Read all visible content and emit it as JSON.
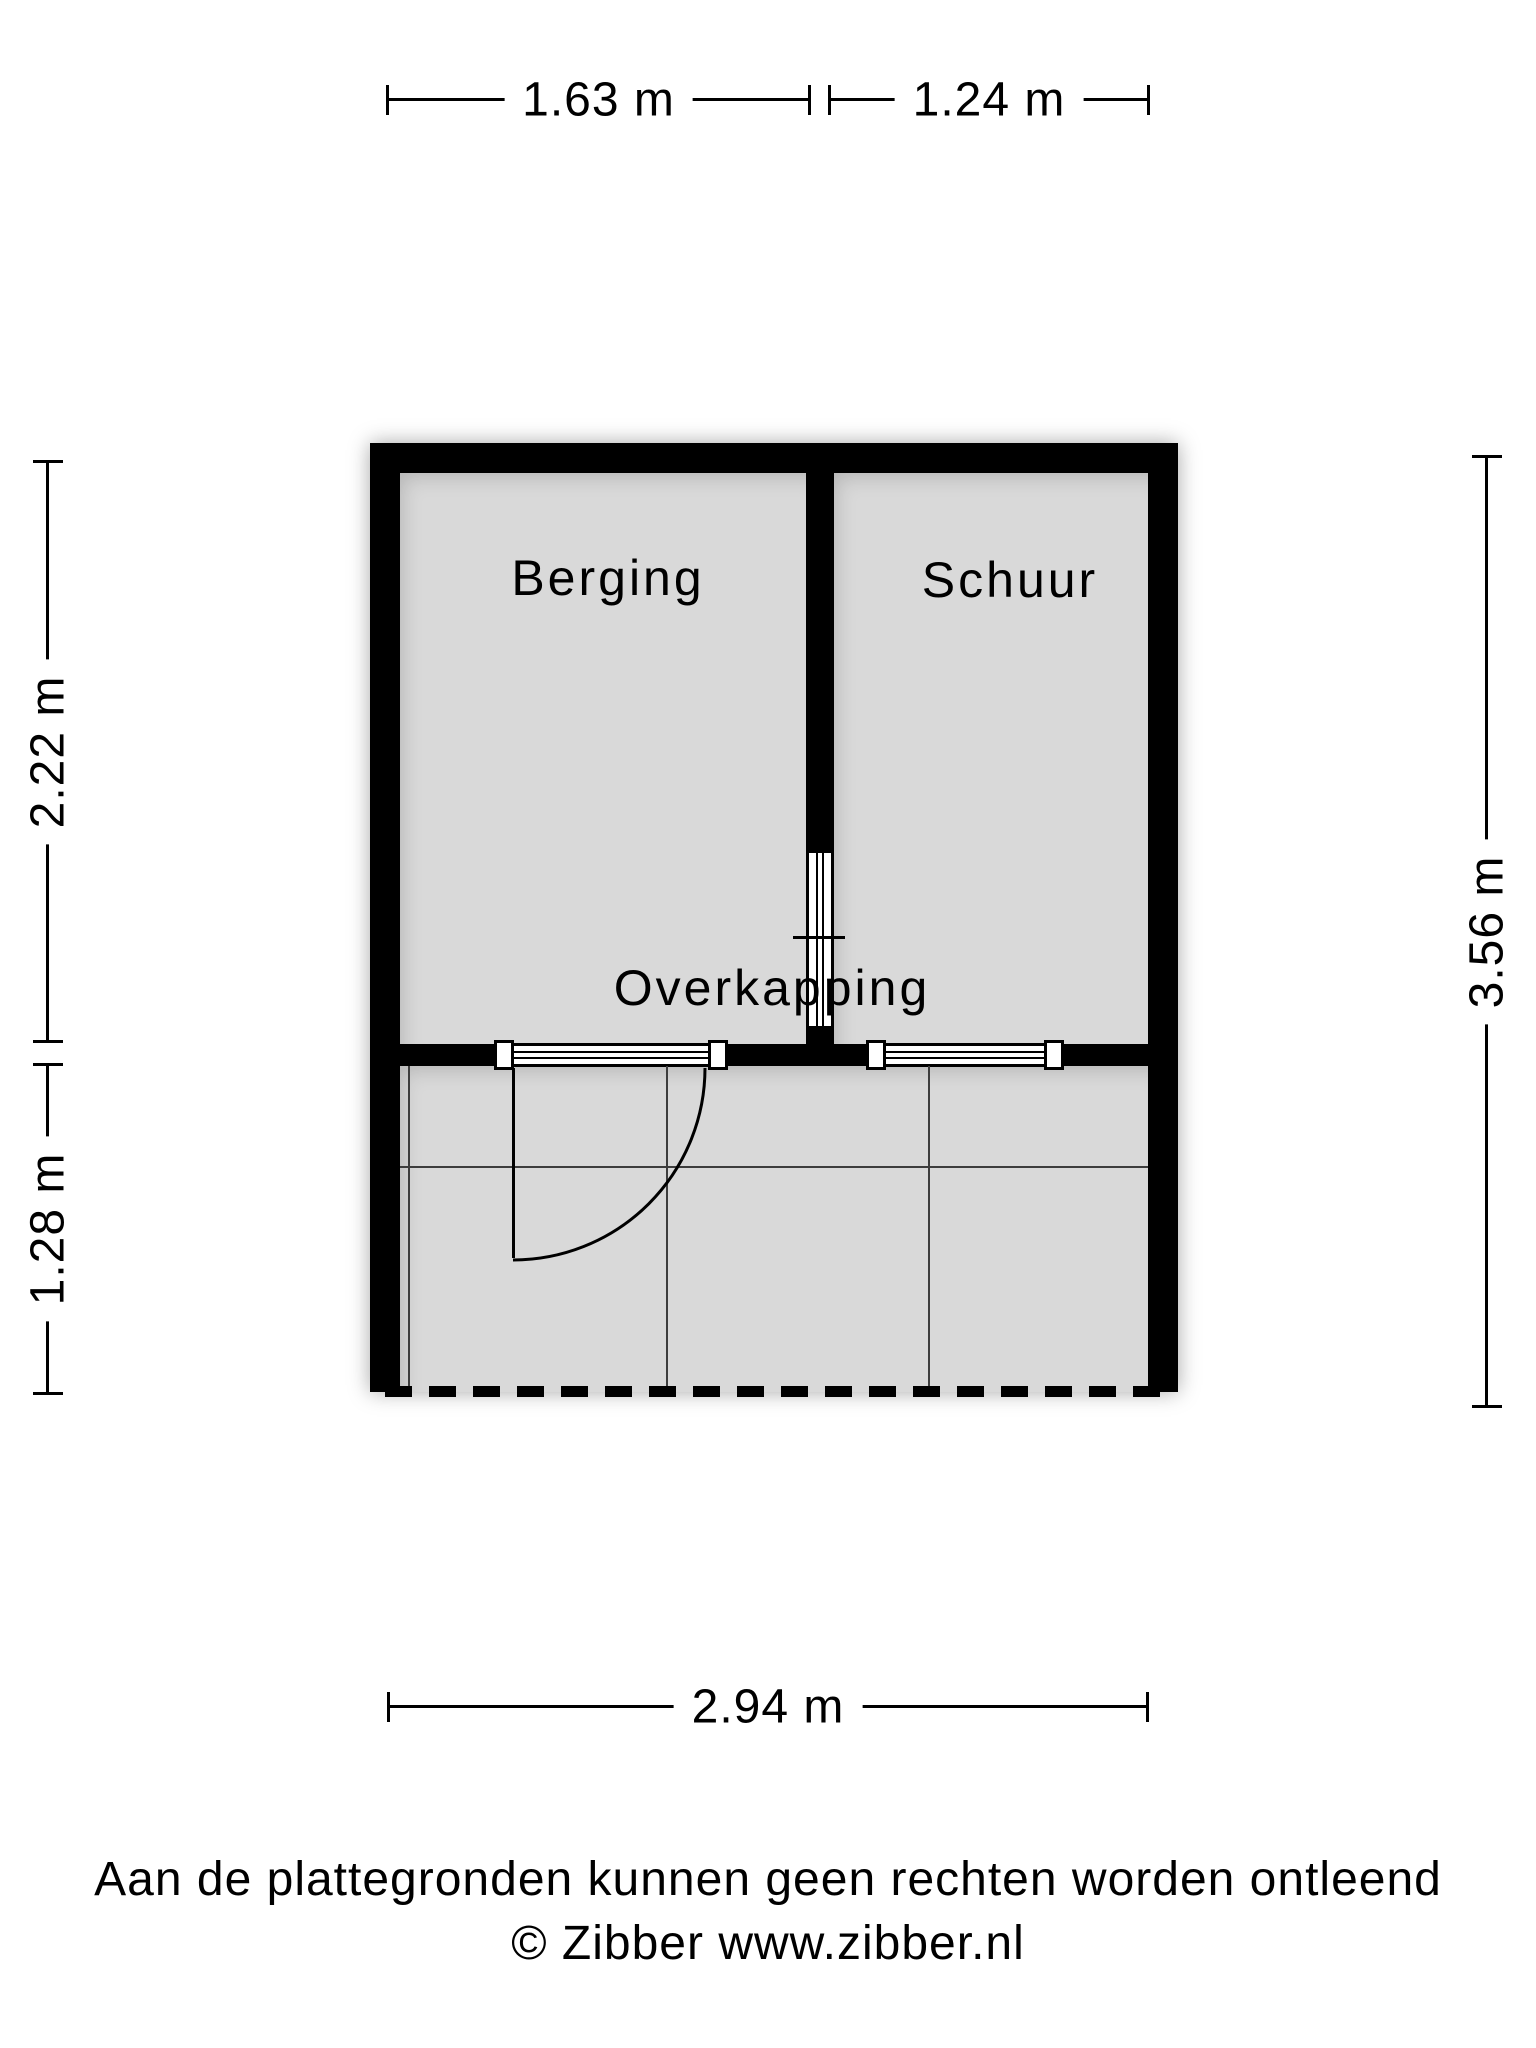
{
  "plan": {
    "rooms": {
      "berging": {
        "label": "Berging"
      },
      "schuur": {
        "label": "Schuur"
      },
      "overkapping": {
        "label": "Overkapping"
      }
    }
  },
  "dimensions": {
    "top_left": {
      "label": "1.63 m"
    },
    "top_right": {
      "label": "1.24 m"
    },
    "left_upper": {
      "label": "2.22 m"
    },
    "left_lower": {
      "label": "1.28 m"
    },
    "right_side": {
      "label": "3.56 m"
    },
    "bottom": {
      "label": "2.94 m"
    }
  },
  "footer": {
    "disclaimer": "Aan de plattegronden kunnen geen rechten worden ontleend",
    "copyright": "© Zibber www.zibber.nl"
  },
  "colors": {
    "wall": "#000000",
    "floor_fill": "#d9d9d9",
    "background": "#ffffff"
  }
}
